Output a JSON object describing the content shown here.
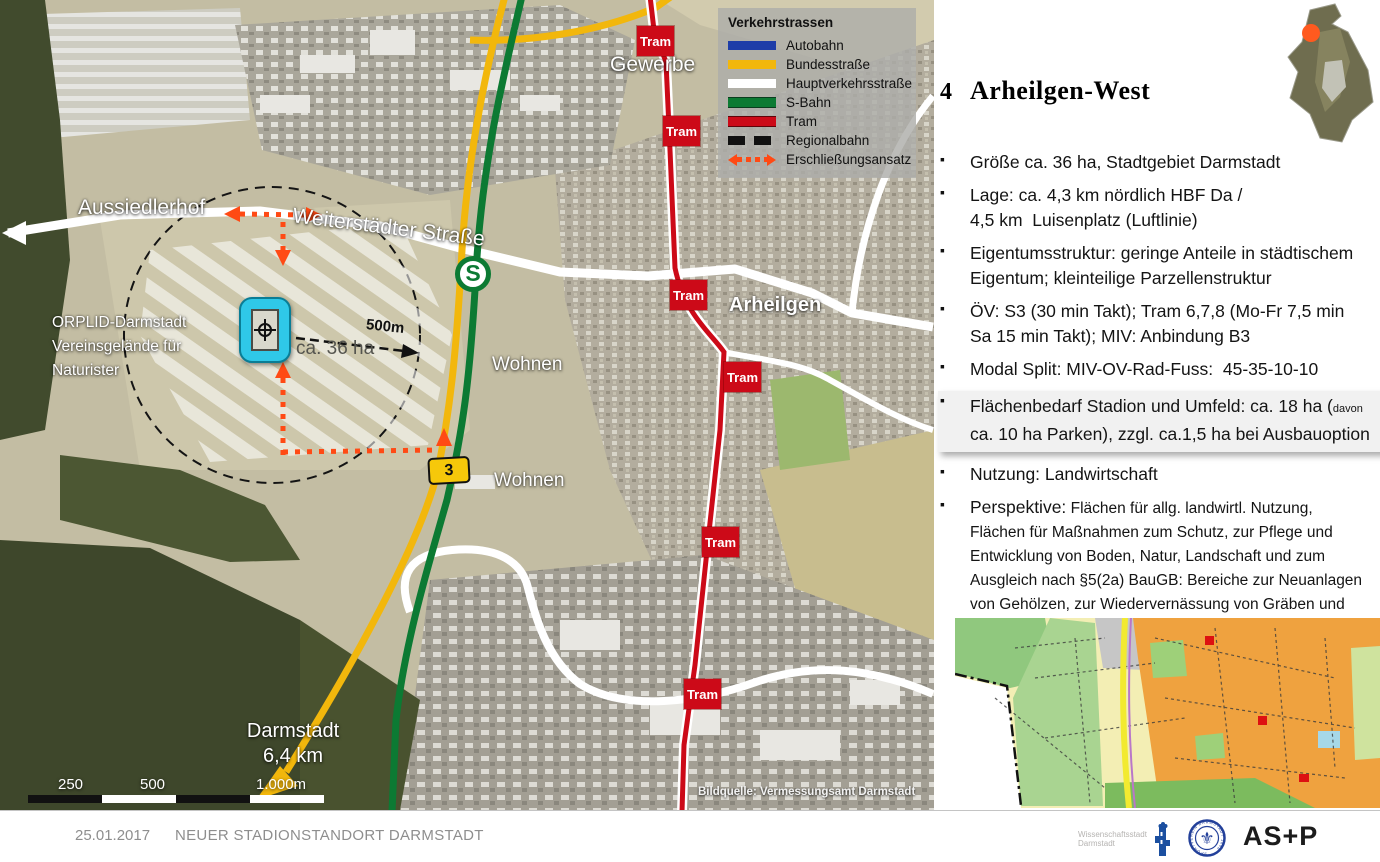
{
  "slide": {
    "number": "4",
    "title": "Arheilgen-West"
  },
  "legend": {
    "title": "Verkehrstrassen",
    "items": [
      {
        "label": "Autobahn",
        "color": "#1e3da8"
      },
      {
        "label": "Bundesstraße",
        "color": "#f2b70c"
      },
      {
        "label": "Hauptverkehrsstraße",
        "color": "#ffffff"
      },
      {
        "label": "S-Bahn",
        "color": "#0c7a33"
      },
      {
        "label": "Tram",
        "color": "#cc0a18"
      },
      {
        "label": "Regionalbahn",
        "color": "#111111"
      },
      {
        "label": "Erschließungsansatz",
        "color": "#ff4a14"
      }
    ]
  },
  "map": {
    "labels": {
      "gewerbe": "Gewerbe",
      "aussiedlerhof": "Aussiedlerhof",
      "weiterstaedter_strasse": "Weiterstädter Straße",
      "wohnen_nord": "Wohnen",
      "wohnen_sued": "Wohnen",
      "arheilgen": "Arheilgen"
    },
    "orplid_lines": [
      "ORPLID-Darmstadt",
      "Vereinsgelände für",
      "Naturister"
    ],
    "darmstadt_distance": [
      "Darmstadt",
      "6,4 km"
    ],
    "tram_label": "Tram",
    "sbahn_symbol": "S",
    "b3_label": "3",
    "radius_label": "500m",
    "area_label": "ca. 36 ha",
    "scale_ticks": [
      "250",
      "500",
      "1.000m"
    ],
    "source_note": "Bildquelle: Vermessungsamt Darmstadt"
  },
  "details": {
    "bullets": [
      {
        "lines": [
          "Größe ca. 36 ha, Stadtgebiet Darmstadt"
        ]
      },
      {
        "lines": [
          "Lage: ca. 4,3 km nördlich HBF Da /",
          "4,5 km  Luisenplatz (Luftlinie)"
        ]
      },
      {
        "lines": [
          "Eigentumsstruktur: geringe Anteile in städtischem",
          "Eigentum; kleinteilige Parzellenstruktur"
        ]
      },
      {
        "lines": [
          "ÖV: S3 (30 min Takt); Tram 6,7,8 (Mo-Fr 7,5 min",
          "Sa 15 min Takt); MIV: Anbindung B3"
        ]
      },
      {
        "lines": [
          "Modal Split: MIV-OV-Rad-Fuss:  45-35-10-10"
        ]
      }
    ],
    "flaechenbedarf": {
      "line1": "Flächenbedarf Stadion und Umfeld: ca. 18 ha (",
      "line1_small": "davon",
      "line2": "ca. 10 ha Parken), zzgl. ca.1,5 ha bei Ausbauoption"
    },
    "nutzung": "Nutzung: Landwirtschaft",
    "perspektive": {
      "lead": "Perspektive:",
      "lines": [
        "Flächen für allg. landwirtl. Nutzung,",
        "Flächen für Maßnahmen zum Schutz, zur Pflege und",
        "Entwicklung von Boden, Natur, Landschaft und zum",
        "Ausgleich nach §5(2a) BauGB: Bereiche zur Neuanlagen",
        "von Gehölzen, zur Wiedervernässung von Gräben und",
        "zur Nutzungsextensivierung"
      ]
    }
  },
  "footer": {
    "date": "25.01.2017",
    "title": "NEUER STADIONSTANDORT DARMSTADT",
    "partner_lines": [
      "Wissenschaftsstadt",
      "Darmstadt"
    ],
    "crest_ring_text": "SPORTVEREIN DARMSTADT 1898",
    "asp_logo": "AS+P"
  }
}
